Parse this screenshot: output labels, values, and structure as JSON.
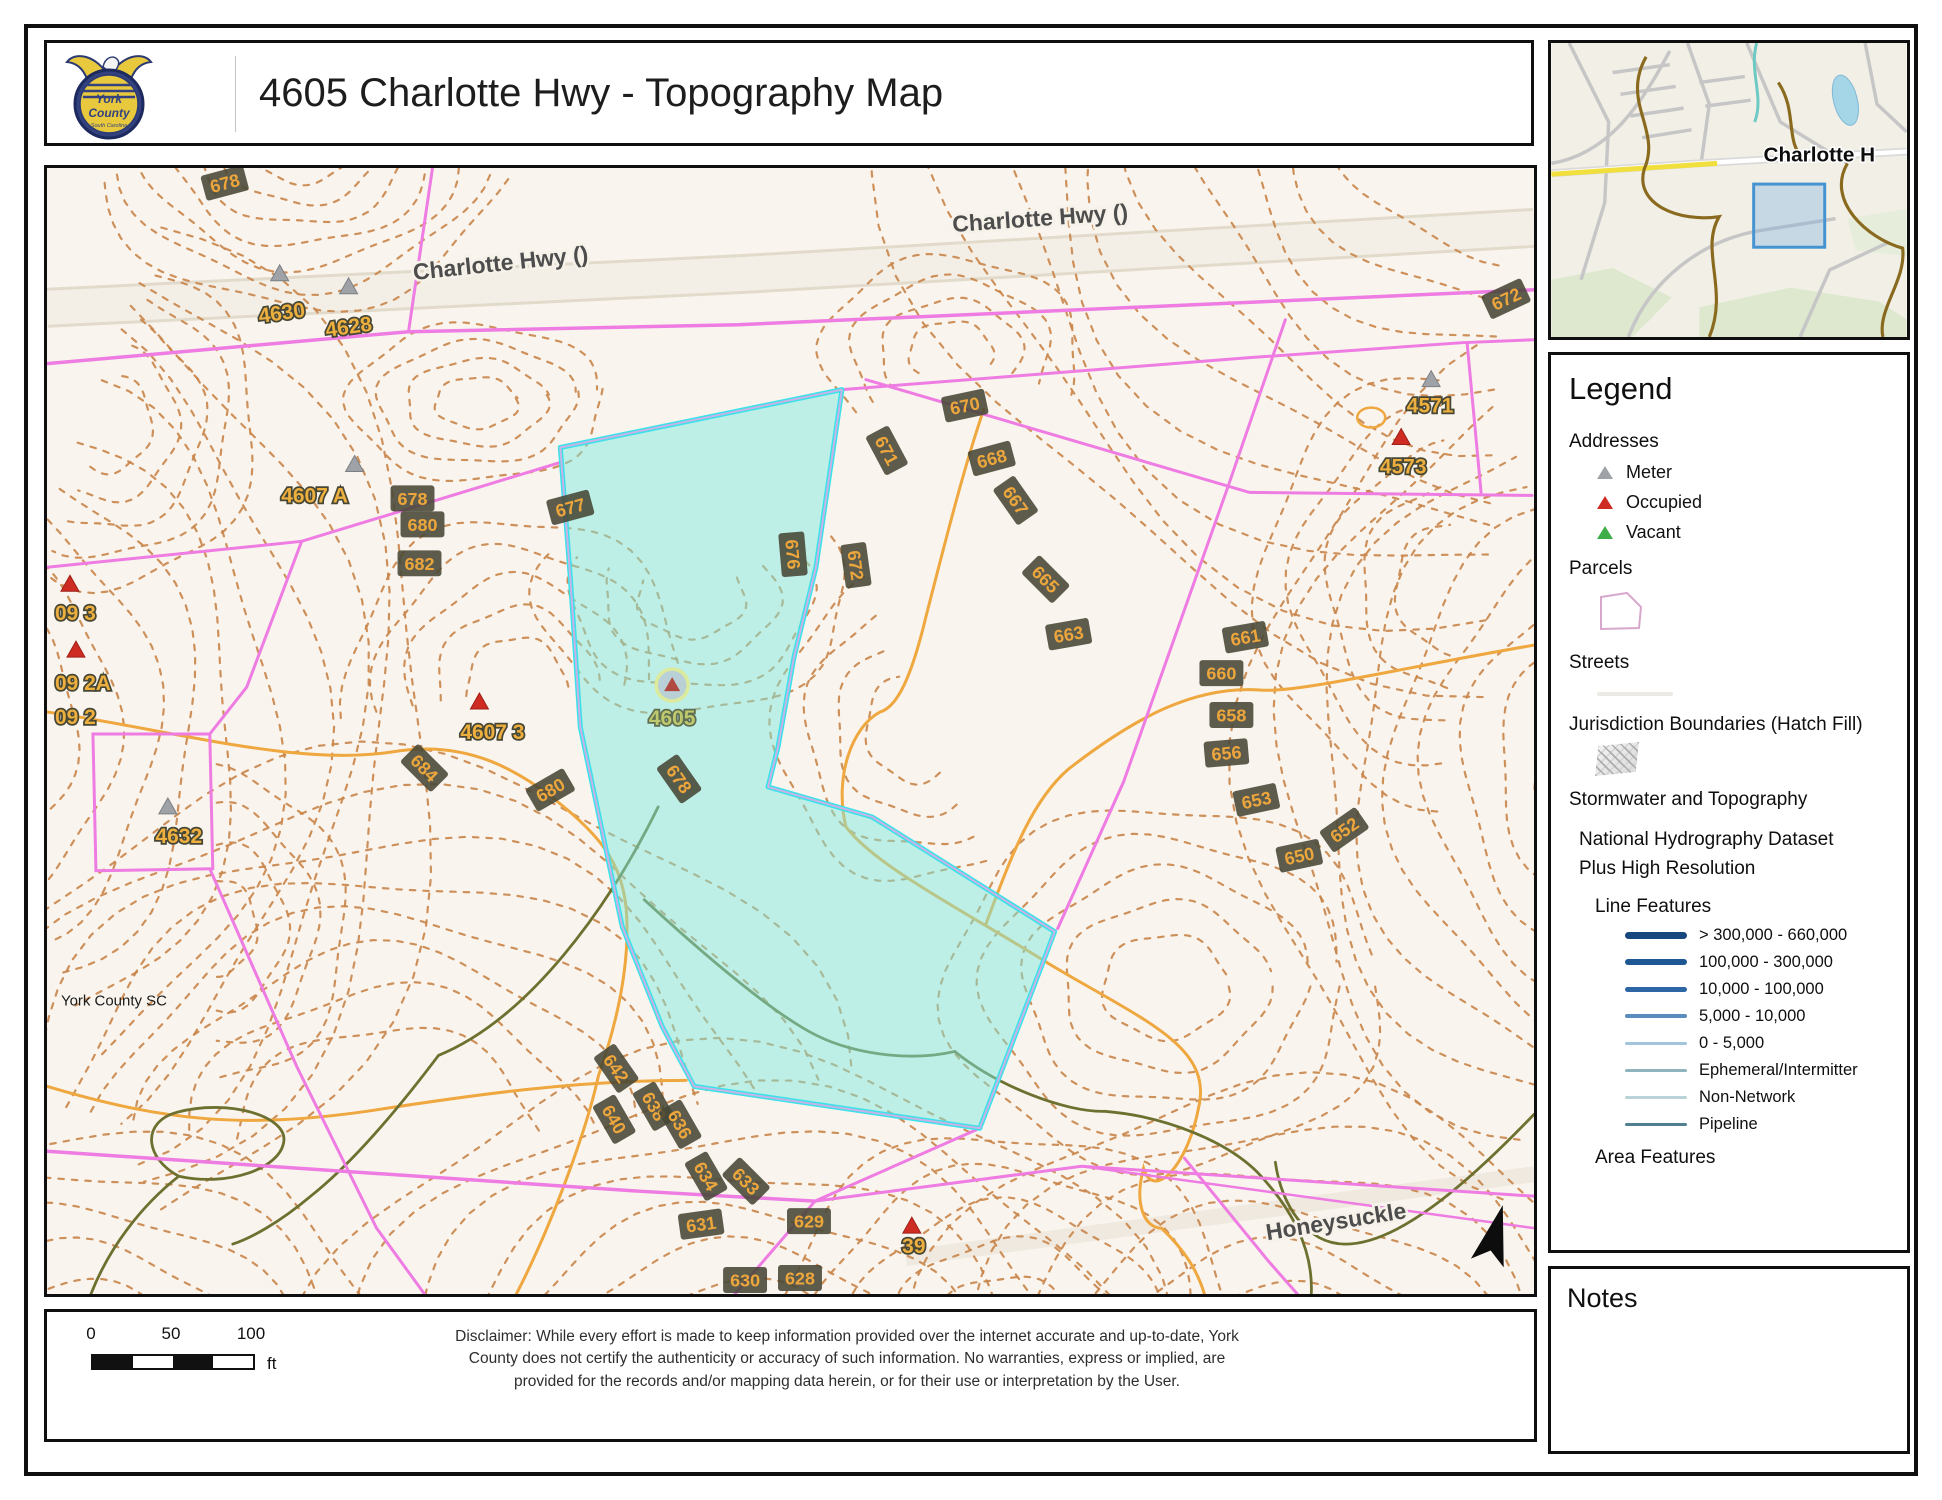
{
  "header": {
    "title": "4605 Charlotte Hwy - Topography Map",
    "logo_line1": "York",
    "logo_line2": "County",
    "logo_line3": "South Carolina"
  },
  "minimap": {
    "label": "Charlotte H"
  },
  "legend": {
    "title": "Legend",
    "addresses_label": "Addresses",
    "address_items": [
      {
        "label": "Meter",
        "color": "#9fa3a7"
      },
      {
        "label": "Occupied",
        "color": "#ce2b22"
      },
      {
        "label": "Vacant",
        "color": "#3fae49"
      }
    ],
    "parcels_label": "Parcels",
    "streets_label": "Streets",
    "jurisdiction_label": "Jurisdiction Boundaries (Hatch Fill)",
    "stormwater_label": "Stormwater and Topography",
    "nhd_label_line1": "National Hydrography Dataset",
    "nhd_label_line2": "Plus High Resolution",
    "line_features_label": "Line Features",
    "line_features": [
      {
        "label": "> 300,000 - 660,000",
        "color": "#17477e",
        "weight": 7
      },
      {
        "label": "100,000 - 300,000",
        "color": "#1f5795",
        "weight": 6
      },
      {
        "label": "10,000 - 100,000",
        "color": "#2d66a5",
        "weight": 5
      },
      {
        "label": "5,000 - 10,000",
        "color": "#5b8cbe",
        "weight": 4
      },
      {
        "label": "0 - 5,000",
        "color": "#a3c4dd",
        "weight": 3.5
      },
      {
        "label": "Ephemeral/Intermitter",
        "color": "#8fb4bd",
        "weight": 2.5
      },
      {
        "label": "Non-Network",
        "color": "#b9d3d8",
        "weight": 2.5
      },
      {
        "label": "Pipeline",
        "color": "#4f7f91",
        "weight": 2.5
      }
    ],
    "area_features_label": "Area Features"
  },
  "notes": {
    "title": "Notes"
  },
  "scalebar": {
    "ticks": [
      "0",
      "50",
      "100"
    ],
    "unit": "ft"
  },
  "disclaimer": "Disclaimer: While every effort is made to keep information provided over the internet accurate and up-to-date, York County does not certify the authenticity or accuracy of such information. No warranties, express or implied, are provided for the records and/or mapping data herein, or for their use or interpretation by the User.",
  "map": {
    "watermark": "York County SC",
    "subject_parcel": {
      "id": "4605",
      "marker_x": 626,
      "marker_y": 518
    },
    "streets": [
      {
        "label": "Charlotte Hwy ()",
        "x": 455,
        "y": 103,
        "rot": -6
      },
      {
        "label": "Charlotte Hwy ()",
        "x": 995,
        "y": 58,
        "rot": -4
      },
      {
        "label": "Honeysuckle",
        "x": 1292,
        "y": 1063,
        "rot": -9
      }
    ],
    "addresses": [
      {
        "label": "4630",
        "x": 236,
        "y": 152,
        "rot": -8
      },
      {
        "label": "4628",
        "x": 303,
        "y": 166,
        "rot": -8
      },
      {
        "label": "4607 A",
        "x": 268,
        "y": 335,
        "rot": 0
      },
      {
        "label": "4632",
        "x": 132,
        "y": 676,
        "rot": 0
      },
      {
        "label": "4607 3",
        "x": 446,
        "y": 572,
        "rot": 0
      },
      {
        "label": "09 3",
        "x": 8,
        "y": 453,
        "rot": 0,
        "anchor": "start"
      },
      {
        "label": "09 2A",
        "x": 8,
        "y": 523,
        "rot": 0,
        "anchor": "start"
      },
      {
        "label": "09 2",
        "x": 8,
        "y": 557,
        "rot": 0,
        "anchor": "start"
      },
      {
        "label": "4571",
        "x": 1385,
        "y": 245,
        "rot": 0
      },
      {
        "label": "4573",
        "x": 1358,
        "y": 306,
        "rot": 0
      },
      {
        "label": "39",
        "x": 868,
        "y": 1087,
        "rot": 0
      },
      {
        "label": "4605",
        "x": 626,
        "y": 558,
        "rot": 0,
        "color": "#bdc96c",
        "outline": "#5f6e53"
      }
    ],
    "contour_labels": [
      {
        "label": "678",
        "x": 178,
        "y": 15,
        "rot": -15
      },
      {
        "label": "672",
        "x": 1461,
        "y": 131,
        "rot": -25
      },
      {
        "label": "670",
        "x": 919,
        "y": 238,
        "rot": -12
      },
      {
        "label": "671",
        "x": 841,
        "y": 283,
        "rot": 62
      },
      {
        "label": "668",
        "x": 946,
        "y": 291,
        "rot": -15
      },
      {
        "label": "667",
        "x": 970,
        "y": 333,
        "rot": 55
      },
      {
        "label": "676",
        "x": 747,
        "y": 387,
        "rot": 85
      },
      {
        "label": "672",
        "x": 810,
        "y": 398,
        "rot": 82
      },
      {
        "label": "665",
        "x": 1000,
        "y": 412,
        "rot": 45
      },
      {
        "label": "663",
        "x": 1023,
        "y": 467,
        "rot": -10
      },
      {
        "label": "661",
        "x": 1200,
        "y": 470,
        "rot": -10
      },
      {
        "label": "660",
        "x": 1176,
        "y": 506,
        "rot": 0
      },
      {
        "label": "658",
        "x": 1186,
        "y": 548,
        "rot": 0
      },
      {
        "label": "656",
        "x": 1181,
        "y": 586,
        "rot": -5
      },
      {
        "label": "653",
        "x": 1211,
        "y": 633,
        "rot": -12
      },
      {
        "label": "652",
        "x": 1299,
        "y": 663,
        "rot": -35
      },
      {
        "label": "650",
        "x": 1254,
        "y": 689,
        "rot": -12
      },
      {
        "label": "677",
        "x": 524,
        "y": 340,
        "rot": -15
      },
      {
        "label": "678",
        "x": 633,
        "y": 612,
        "rot": 55
      },
      {
        "label": "678",
        "x": 366,
        "y": 331,
        "rot": 0
      },
      {
        "label": "680",
        "x": 376,
        "y": 357,
        "rot": 0
      },
      {
        "label": "682",
        "x": 373,
        "y": 396,
        "rot": 0
      },
      {
        "label": "684",
        "x": 378,
        "y": 601,
        "rot": 45
      },
      {
        "label": "680",
        "x": 504,
        "y": 623,
        "rot": -30
      },
      {
        "label": "642",
        "x": 570,
        "y": 902,
        "rot": 55
      },
      {
        "label": "640",
        "x": 568,
        "y": 953,
        "rot": 60
      },
      {
        "label": "638",
        "x": 608,
        "y": 940,
        "rot": 60
      },
      {
        "label": "636",
        "x": 634,
        "y": 958,
        "rot": 60
      },
      {
        "label": "634",
        "x": 660,
        "y": 1010,
        "rot": 60
      },
      {
        "label": "633",
        "x": 700,
        "y": 1015,
        "rot": 45
      },
      {
        "label": "631",
        "x": 655,
        "y": 1058,
        "rot": -8
      },
      {
        "label": "629",
        "x": 763,
        "y": 1055,
        "rot": 0
      },
      {
        "label": "630",
        "x": 699,
        "y": 1114,
        "rot": 0
      },
      {
        "label": "628",
        "x": 754,
        "y": 1112,
        "rot": 0
      }
    ],
    "markers": {
      "meter": [
        [
          233,
          106
        ],
        [
          302,
          119
        ],
        [
          308,
          297
        ],
        [
          121,
          640
        ],
        [
          1386,
          212
        ]
      ],
      "occupied": [
        [
          23,
          417
        ],
        [
          29,
          483
        ],
        [
          433,
          535
        ],
        [
          1356,
          270
        ],
        [
          866,
          1060
        ]
      ]
    },
    "colors": {
      "contour": "#c9854a",
      "index_contour": "#efa73f",
      "stream_olive": "#6e7030",
      "parcel_line": "#ee7ce2",
      "highlight_fill": "#7ce7de",
      "highlight_stroke": "#3ae2ea",
      "badge_bg": "#474736",
      "badge_text": "#eda63c",
      "address_text": "#edaf3e",
      "address_outline": "#474736"
    }
  }
}
